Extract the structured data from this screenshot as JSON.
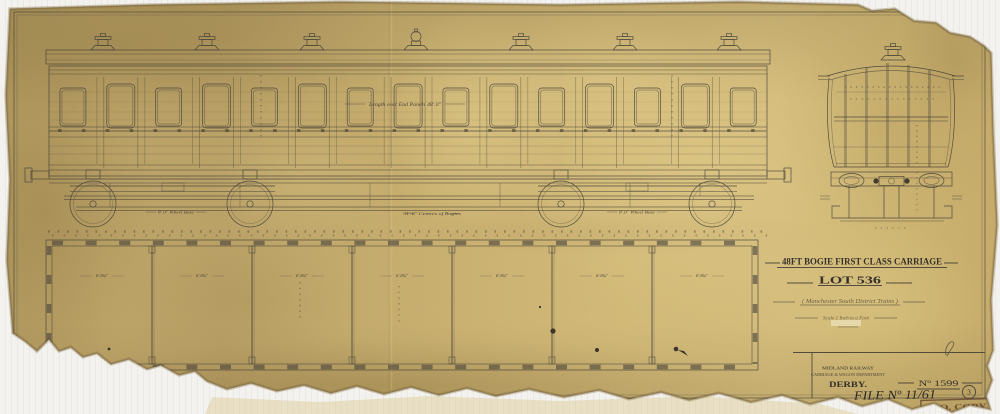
{
  "document_type": "engineering drawing (scanned aged blueprint)",
  "colors": {
    "paper": "#cbb271",
    "ink": "#45413a",
    "handwriting": "#6e5f44",
    "stamp": "#6b4733",
    "background": "#f3f2ee"
  },
  "title_block": {
    "title": "48FT BOGIE FIRST CLASS CARRIAGE",
    "lot": "LOT 536",
    "subtitle": "( Manchester South District Trains )",
    "scale_note": "Scale 1 Inch to a Foot"
  },
  "annotations": {
    "length_over_panels": "Length over End Panels 48'.0\"",
    "wheelbase_left": "8'.0\" Wheel Base",
    "bogie_centres": "31'.6\" Centres of Bogies",
    "wheelbase_right": "8'.0\" Wheel Base"
  },
  "plan": {
    "compartments": [
      "6'.8¾\"",
      "6'.8¾\"",
      "6'.8¾\"",
      "6'.8¾\"",
      "6'.8¾\"",
      "6'.8¾\"",
      "6'.8¾\""
    ]
  },
  "footer": {
    "company": "MIDLAND RAILWAY",
    "department": "CARRIAGE & WAGON DEPARTMENT",
    "location": "DERBY.",
    "drawing_number": "Nº 1599",
    "file_number": "FILE Nº 11/61",
    "sheet_number": "3",
    "stamp": "D.O. COPY"
  }
}
